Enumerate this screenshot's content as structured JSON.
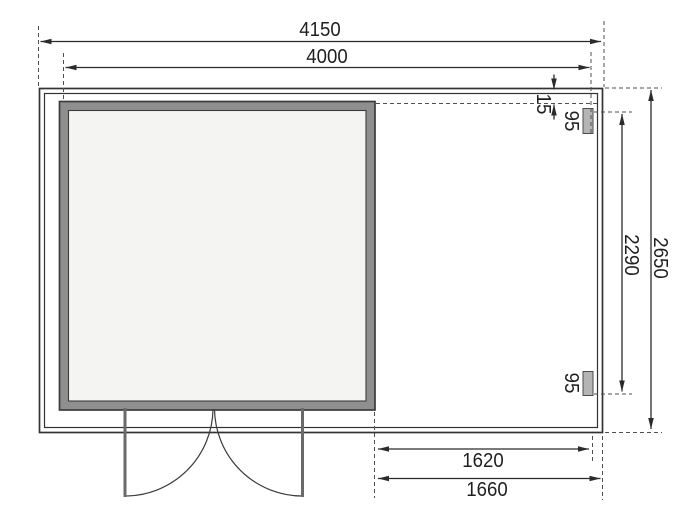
{
  "diagram": {
    "type": "shed-floor-plan",
    "labels": {
      "top_outer_width": "4150",
      "top_inner_width": "4000",
      "right_gap": "15",
      "right_post_top": "95",
      "right_inner_depth": "2290",
      "right_outer_depth": "2650",
      "right_post_bottom": "95",
      "bottom_inner_width": "1620",
      "bottom_outer_width": "1660"
    },
    "colors": {
      "line": "#2b2b2b",
      "dashed_line": "#4f4f4f",
      "wall_outline": "#3c3c3c",
      "room_wall_fill": "#8f8f8f",
      "room_interior_fill": "#f4f4f2",
      "post_fill": "#b4b4b4",
      "door_leaf": "#6a6a6a",
      "background": "#ffffff"
    }
  }
}
